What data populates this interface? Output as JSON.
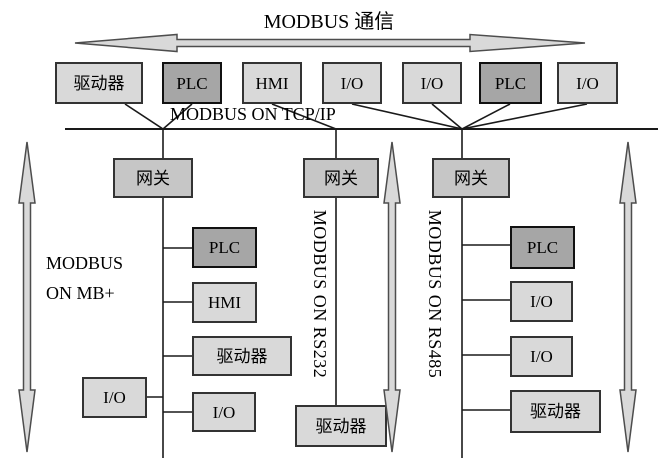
{
  "title": "MODBUS 通信",
  "tcpip_bus": {
    "label": "MODBUS ON TCP/IP"
  },
  "top_devices": [
    {
      "label": "驱动器",
      "type": "light"
    },
    {
      "label": "PLC",
      "type": "dark"
    },
    {
      "label": "HMI",
      "type": "light"
    },
    {
      "label": "I/O",
      "type": "light"
    },
    {
      "label": "I/O",
      "type": "light"
    },
    {
      "label": "PLC",
      "type": "dark"
    },
    {
      "label": "I/O",
      "type": "light"
    }
  ],
  "gateways": [
    {
      "label": "网关"
    },
    {
      "label": "网关"
    },
    {
      "label": "网关"
    }
  ],
  "branches": {
    "mb_plus": {
      "label_line1": "MODBUS",
      "label_line2": "ON MB+",
      "devices": [
        {
          "label": "PLC",
          "type": "dark"
        },
        {
          "label": "HMI",
          "type": "light"
        },
        {
          "label": "驱动器",
          "type": "light"
        },
        {
          "label": "I/O",
          "type": "light"
        },
        {
          "label": "I/O",
          "type": "light"
        }
      ]
    },
    "rs232": {
      "label": "MODBUS ON RS232",
      "devices": [
        {
          "label": "驱动器",
          "type": "light"
        }
      ]
    },
    "rs485": {
      "label": "MODBUS ON RS485",
      "devices": [
        {
          "label": "PLC",
          "type": "dark"
        },
        {
          "label": "I/O",
          "type": "light"
        },
        {
          "label": "I/O",
          "type": "light"
        },
        {
          "label": "驱动器",
          "type": "light"
        }
      ]
    }
  },
  "colors": {
    "background": "#ffffff",
    "box_light": "#d9d9d9",
    "box_dark": "#a6a6a6",
    "box_gateway": "#c6c6c6",
    "border": "#333333",
    "border_dark": "#111111",
    "line": "#1a1a1a",
    "arrow_fill": "#d9d9d9",
    "arrow_stroke": "#4d4d4d",
    "text": "#000000"
  }
}
